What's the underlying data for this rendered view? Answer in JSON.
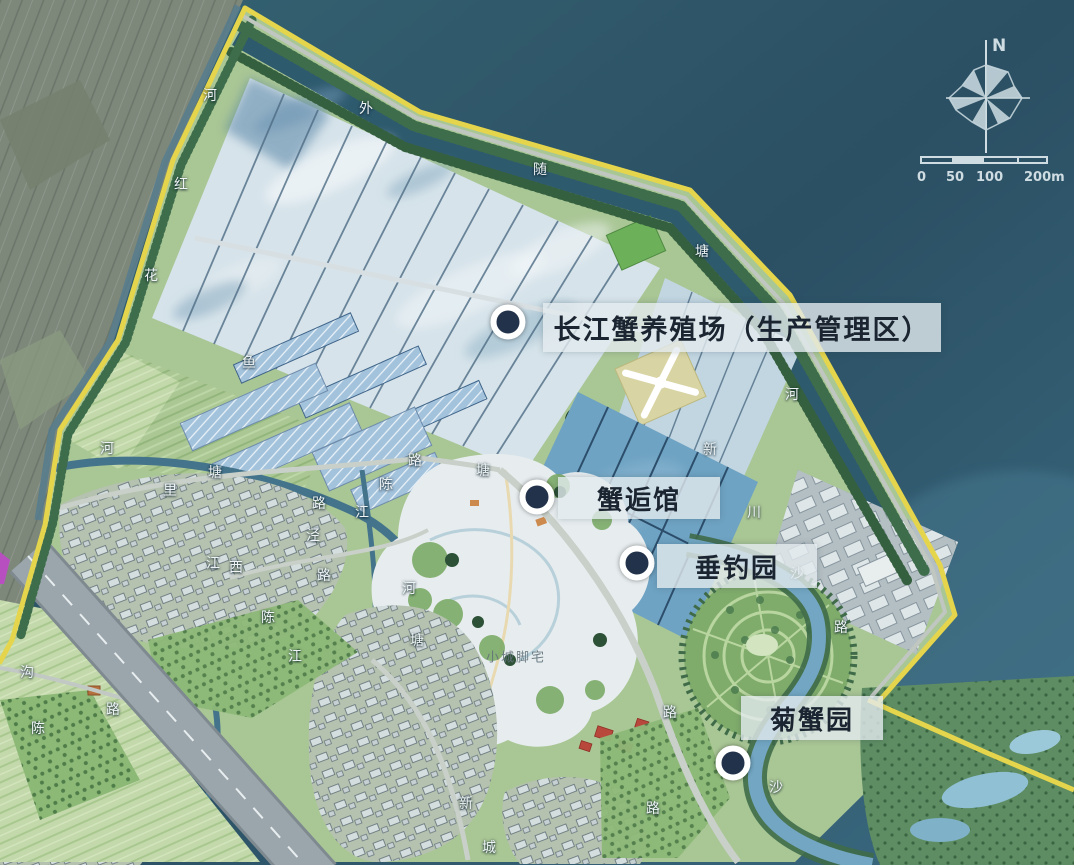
{
  "pois": [
    {
      "name": "changjiang-crab-farm",
      "label": "长江蟹养殖场（生产管理区）",
      "marker": {
        "x": 508,
        "y": 322
      },
      "box": {
        "x": 543,
        "y": 303,
        "w": 398,
        "h": 49,
        "font": 27
      }
    },
    {
      "name": "xiehou-hall",
      "label": "蟹逅馆",
      "marker": {
        "x": 537,
        "y": 497
      },
      "box": {
        "x": 558,
        "y": 477,
        "w": 162,
        "h": 42,
        "font": 26
      }
    },
    {
      "name": "fishing-garden",
      "label": "垂钓园",
      "marker": {
        "x": 637,
        "y": 563
      },
      "box": {
        "x": 657,
        "y": 544,
        "w": 160,
        "h": 44,
        "font": 26
      }
    },
    {
      "name": "chrysanthemum-crab-garden",
      "label": "菊蟹园",
      "marker": {
        "x": 733,
        "y": 763
      },
      "box": {
        "x": 741,
        "y": 696,
        "w": 142,
        "h": 44,
        "font": 26
      }
    }
  ],
  "map_labels": [
    {
      "t": "河",
      "x": 210,
      "y": 95
    },
    {
      "t": "红",
      "x": 181,
      "y": 184
    },
    {
      "t": "花",
      "x": 151,
      "y": 275
    },
    {
      "t": "外",
      "x": 366,
      "y": 108
    },
    {
      "t": "随",
      "x": 540,
      "y": 169
    },
    {
      "t": "塘",
      "x": 702,
      "y": 251
    },
    {
      "t": "河",
      "x": 792,
      "y": 394
    },
    {
      "t": "新",
      "x": 710,
      "y": 449
    },
    {
      "t": "川",
      "x": 754,
      "y": 512
    },
    {
      "t": "沙",
      "x": 797,
      "y": 573
    },
    {
      "t": "路",
      "x": 841,
      "y": 627
    },
    {
      "t": "鱼",
      "x": 249,
      "y": 362
    },
    {
      "t": "河",
      "x": 107,
      "y": 448
    },
    {
      "t": "塘",
      "x": 215,
      "y": 472
    },
    {
      "t": "里",
      "x": 170,
      "y": 490
    },
    {
      "t": "路",
      "x": 415,
      "y": 460
    },
    {
      "t": "陈",
      "x": 386,
      "y": 484
    },
    {
      "t": "塘",
      "x": 483,
      "y": 470
    },
    {
      "t": "路",
      "x": 319,
      "y": 503
    },
    {
      "t": "江",
      "x": 362,
      "y": 512
    },
    {
      "t": "泾",
      "x": 313,
      "y": 535
    },
    {
      "t": "江",
      "x": 213,
      "y": 563
    },
    {
      "t": "西",
      "x": 236,
      "y": 567
    },
    {
      "t": "路",
      "x": 324,
      "y": 575
    },
    {
      "t": "陈",
      "x": 268,
      "y": 617
    },
    {
      "t": "河",
      "x": 409,
      "y": 588
    },
    {
      "t": "塘",
      "x": 417,
      "y": 640
    },
    {
      "t": "江",
      "x": 295,
      "y": 656
    },
    {
      "t": "沟",
      "x": 27,
      "y": 672
    },
    {
      "t": "路",
      "x": 113,
      "y": 709
    },
    {
      "t": "陈",
      "x": 38,
      "y": 728
    },
    {
      "t": "路",
      "x": 670,
      "y": 712
    },
    {
      "t": "沙",
      "x": 776,
      "y": 787
    },
    {
      "t": "路",
      "x": 653,
      "y": 808
    },
    {
      "t": "新",
      "x": 466,
      "y": 803
    },
    {
      "t": "城",
      "x": 489,
      "y": 847
    },
    {
      "t": "小城脚宅",
      "x": 516,
      "y": 656,
      "cls": "faint"
    }
  ],
  "compass": {
    "north_label": "N"
  },
  "scalebar": {
    "labels": [
      "0",
      "50",
      "100",
      "200m"
    ],
    "total_meters": 200
  },
  "colors": {
    "marker_fill": "#22324a",
    "marker_ring": "#ffffff",
    "label_bg": "rgba(226,234,238,0.8)",
    "label_text": "#1b2531",
    "boundary_yellow": "#e5d54c",
    "sea": "#2e5a6e",
    "compass": "#cfdde2"
  }
}
